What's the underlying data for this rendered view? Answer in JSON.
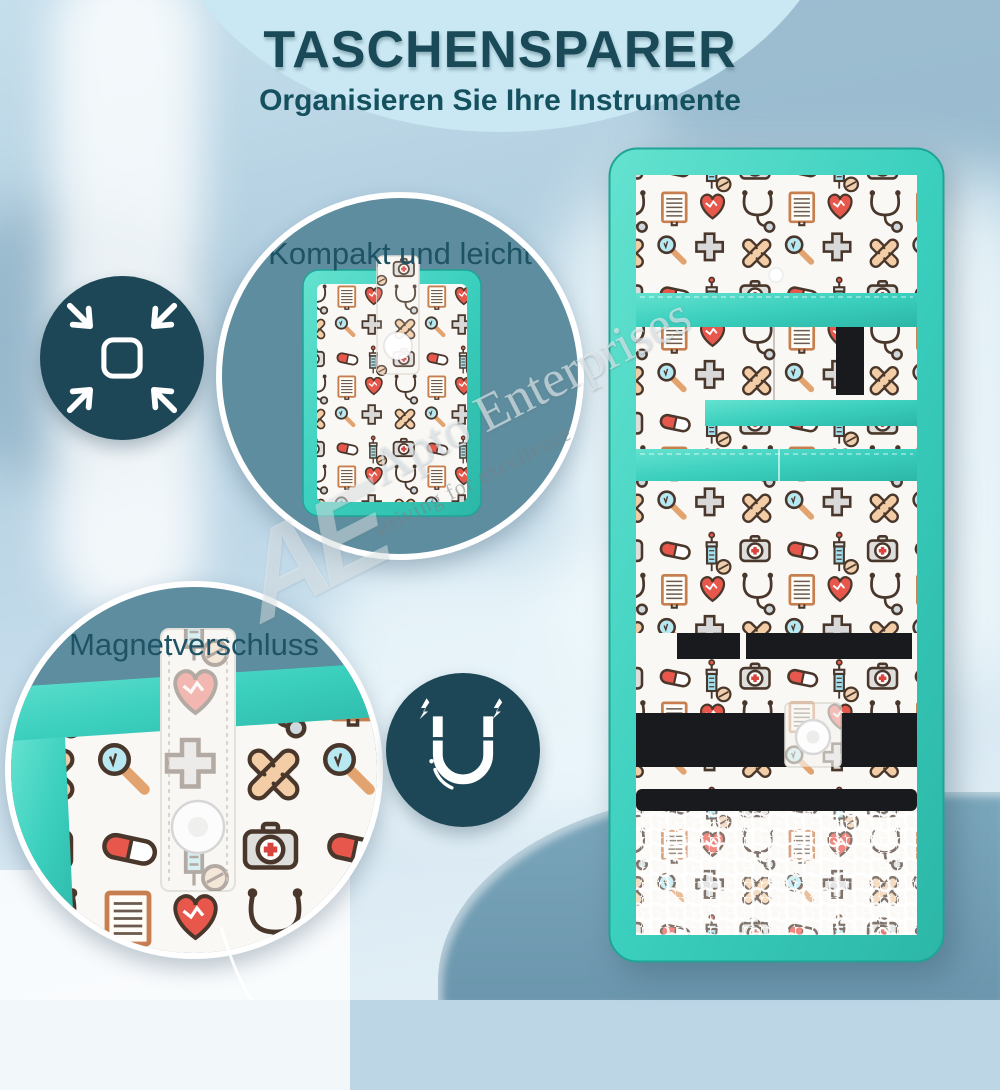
{
  "header": {
    "title": "TASCHENSPARER",
    "subtitle": "Organisieren Sie Ihre Instrumente"
  },
  "callouts": {
    "compact": {
      "label": "Kompakt und leicht",
      "icon": "compress-arrows-icon"
    },
    "magnet": {
      "label": "Magnetverschluss",
      "icon": "magnet-icon"
    }
  },
  "watermark": {
    "monogram": "AE",
    "name": "Apto Enterprises",
    "tagline": "striving for excellence"
  },
  "colors": {
    "banner_bg": "#C9E8F3",
    "title_text": "#1A4A57",
    "callout_circle": "#5D8D9E",
    "icon_circle": "#1D4757",
    "trim_teal": "#3BCFBE",
    "fabric_white": "#FAF8F4",
    "elastic_black": "#191A1E",
    "background_slate": "#6E9CB3",
    "pattern_red": "#E8574B",
    "pattern_tan": "#F3CDA6",
    "pattern_blue": "#A5E2F0"
  }
}
